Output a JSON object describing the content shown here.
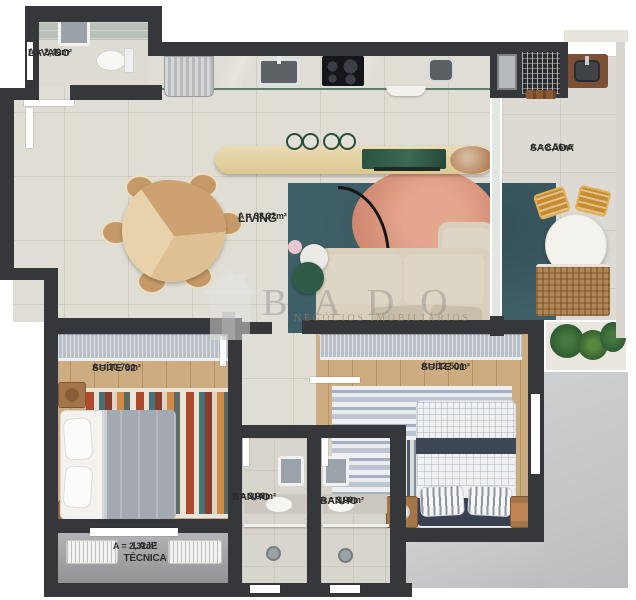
{
  "title": "Apartment floor plan",
  "watermark": {
    "brand": "BADO",
    "subtitle": "NEGÓCIOS IMOBILIÁRIOS"
  },
  "rooms": {
    "lavabo": {
      "name": "LAVABO",
      "area": "A = 2,40m²"
    },
    "living": {
      "name": "LIVING",
      "area": "A = 38,32m²"
    },
    "sacada": {
      "name": "SACADA",
      "area": "A = 8,56m²"
    },
    "suite02": {
      "name": "SUÍTE 02",
      "area": "A = 10,79m²"
    },
    "suite01": {
      "name": "SUÍTE 01",
      "area": "A = 12,50m²"
    },
    "banho1": {
      "name": "BANHO",
      "area": "A = 3,00m²"
    },
    "banho2": {
      "name": "BANHO",
      "area": "A = 3,00m²"
    },
    "laje": {
      "name": "LAJE TÉCNICA",
      "area": "A = 2,32m²"
    }
  },
  "colors": {
    "wall": "#35373a",
    "floor_tile": "#e0ddd4",
    "wood_floor": "#cdac80",
    "kitchen_counter_green": "#84a392",
    "living_rug_teal": "#3f5f68",
    "rug_circle_salmon": "#dd9880",
    "sofa_beige": "#d8cfbc",
    "exterior_gray": "#c6c8ca",
    "label_text": "#2d2d2d"
  }
}
